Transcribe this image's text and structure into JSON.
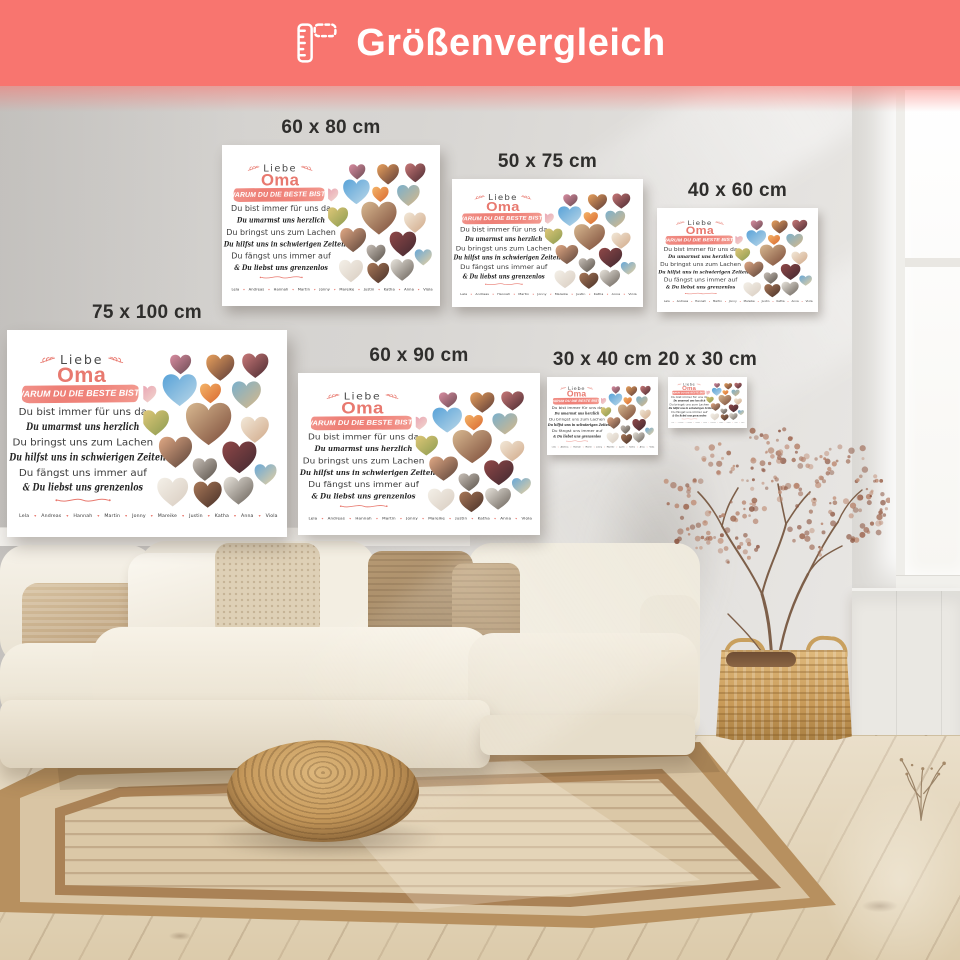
{
  "header": {
    "title": "Größenvergleich",
    "icon": "ruler-icon",
    "bg_color": "#f8756f",
    "text_color": "#ffffff"
  },
  "sizes": [
    "60 x 80 cm",
    "50 x 75 cm",
    "40 x 60 cm",
    "75 x 100 cm",
    "60 x 90 cm",
    "30 x 40 cm",
    "20 x 30 cm"
  ],
  "poster": {
    "greeting": "Liebe",
    "recipient": "Oma",
    "banner": "WARUM DU DIE BESTE BIST?",
    "lines": [
      {
        "style": "print",
        "text": "Du bist immer für uns da"
      },
      {
        "style": "script",
        "text": "Du umarmst uns herzlich"
      },
      {
        "style": "print",
        "text": "Du bringst uns zum Lachen"
      },
      {
        "style": "script",
        "text": "Du hilfst uns in schwierigen Zeiten"
      },
      {
        "style": "print",
        "text": "Du fängst uns immer auf"
      },
      {
        "style": "script",
        "text": "& Du liebst uns grenzenlos"
      }
    ],
    "names": [
      "Lela",
      "Andreas",
      "Hannah",
      "Martin",
      "Jonny",
      "Mareike",
      "Justin",
      "Katha",
      "Anna",
      "Viola"
    ],
    "heart_separator": "♥",
    "accent_color": "#e8796f",
    "banner_color": "#f0837b",
    "text_color": "#3c3c3c",
    "hearts": [
      {
        "x": 80,
        "y": 54,
        "s": 45,
        "c1": "#d88ca0",
        "c2": "#6a4a52"
      },
      {
        "x": 165,
        "y": 60,
        "s": 60,
        "c1": "#e8a05c",
        "c2": "#5a3a38"
      },
      {
        "x": 240,
        "y": 56,
        "s": 56,
        "c1": "#c87878",
        "c2": "#4a2a30"
      },
      {
        "x": 78,
        "y": 108,
        "s": 73,
        "c1": "#58a2d8",
        "c2": "#bcd8e8"
      },
      {
        "x": 144,
        "y": 117,
        "s": 45,
        "c1": "#f4b468",
        "c2": "#d86830"
      },
      {
        "x": 221,
        "y": 119,
        "s": 62,
        "c1": "#7ab0cc",
        "c2": "#d8b888"
      },
      {
        "x": 9,
        "y": 119,
        "s": 38,
        "c1": "#e8a0b0",
        "c2": "#f2d8d0"
      },
      {
        "x": 26,
        "y": 180,
        "s": 58,
        "c1": "#e0c878",
        "c2": "#8a9a50"
      },
      {
        "x": 140,
        "y": 180,
        "s": 97,
        "c1": "#d8b890",
        "c2": "#7a4a38"
      },
      {
        "x": 239,
        "y": 195,
        "s": 60,
        "c1": "#f2e8d8",
        "c2": "#d0a888"
      },
      {
        "x": 69,
        "y": 243,
        "s": 71,
        "c1": "#e0a884",
        "c2": "#5a4238"
      },
      {
        "x": 132,
        "y": 282,
        "s": 52,
        "c1": "#c8c0b8",
        "c2": "#585048"
      },
      {
        "x": 206,
        "y": 254,
        "s": 73,
        "c1": "#904848",
        "c2": "#402830"
      },
      {
        "x": 262,
        "y": 293,
        "s": 47,
        "c1": "#68a8d8",
        "c2": "#e8d0a0"
      },
      {
        "x": 63,
        "y": 330,
        "s": 66,
        "c1": "#f4f0e8",
        "c2": "#d8ccc0"
      },
      {
        "x": 138,
        "y": 336,
        "s": 60,
        "c1": "#a87858",
        "c2": "#483028"
      },
      {
        "x": 204,
        "y": 327,
        "s": 64,
        "c1": "#e8e4dc",
        "c2": "#686058"
      }
    ]
  }
}
